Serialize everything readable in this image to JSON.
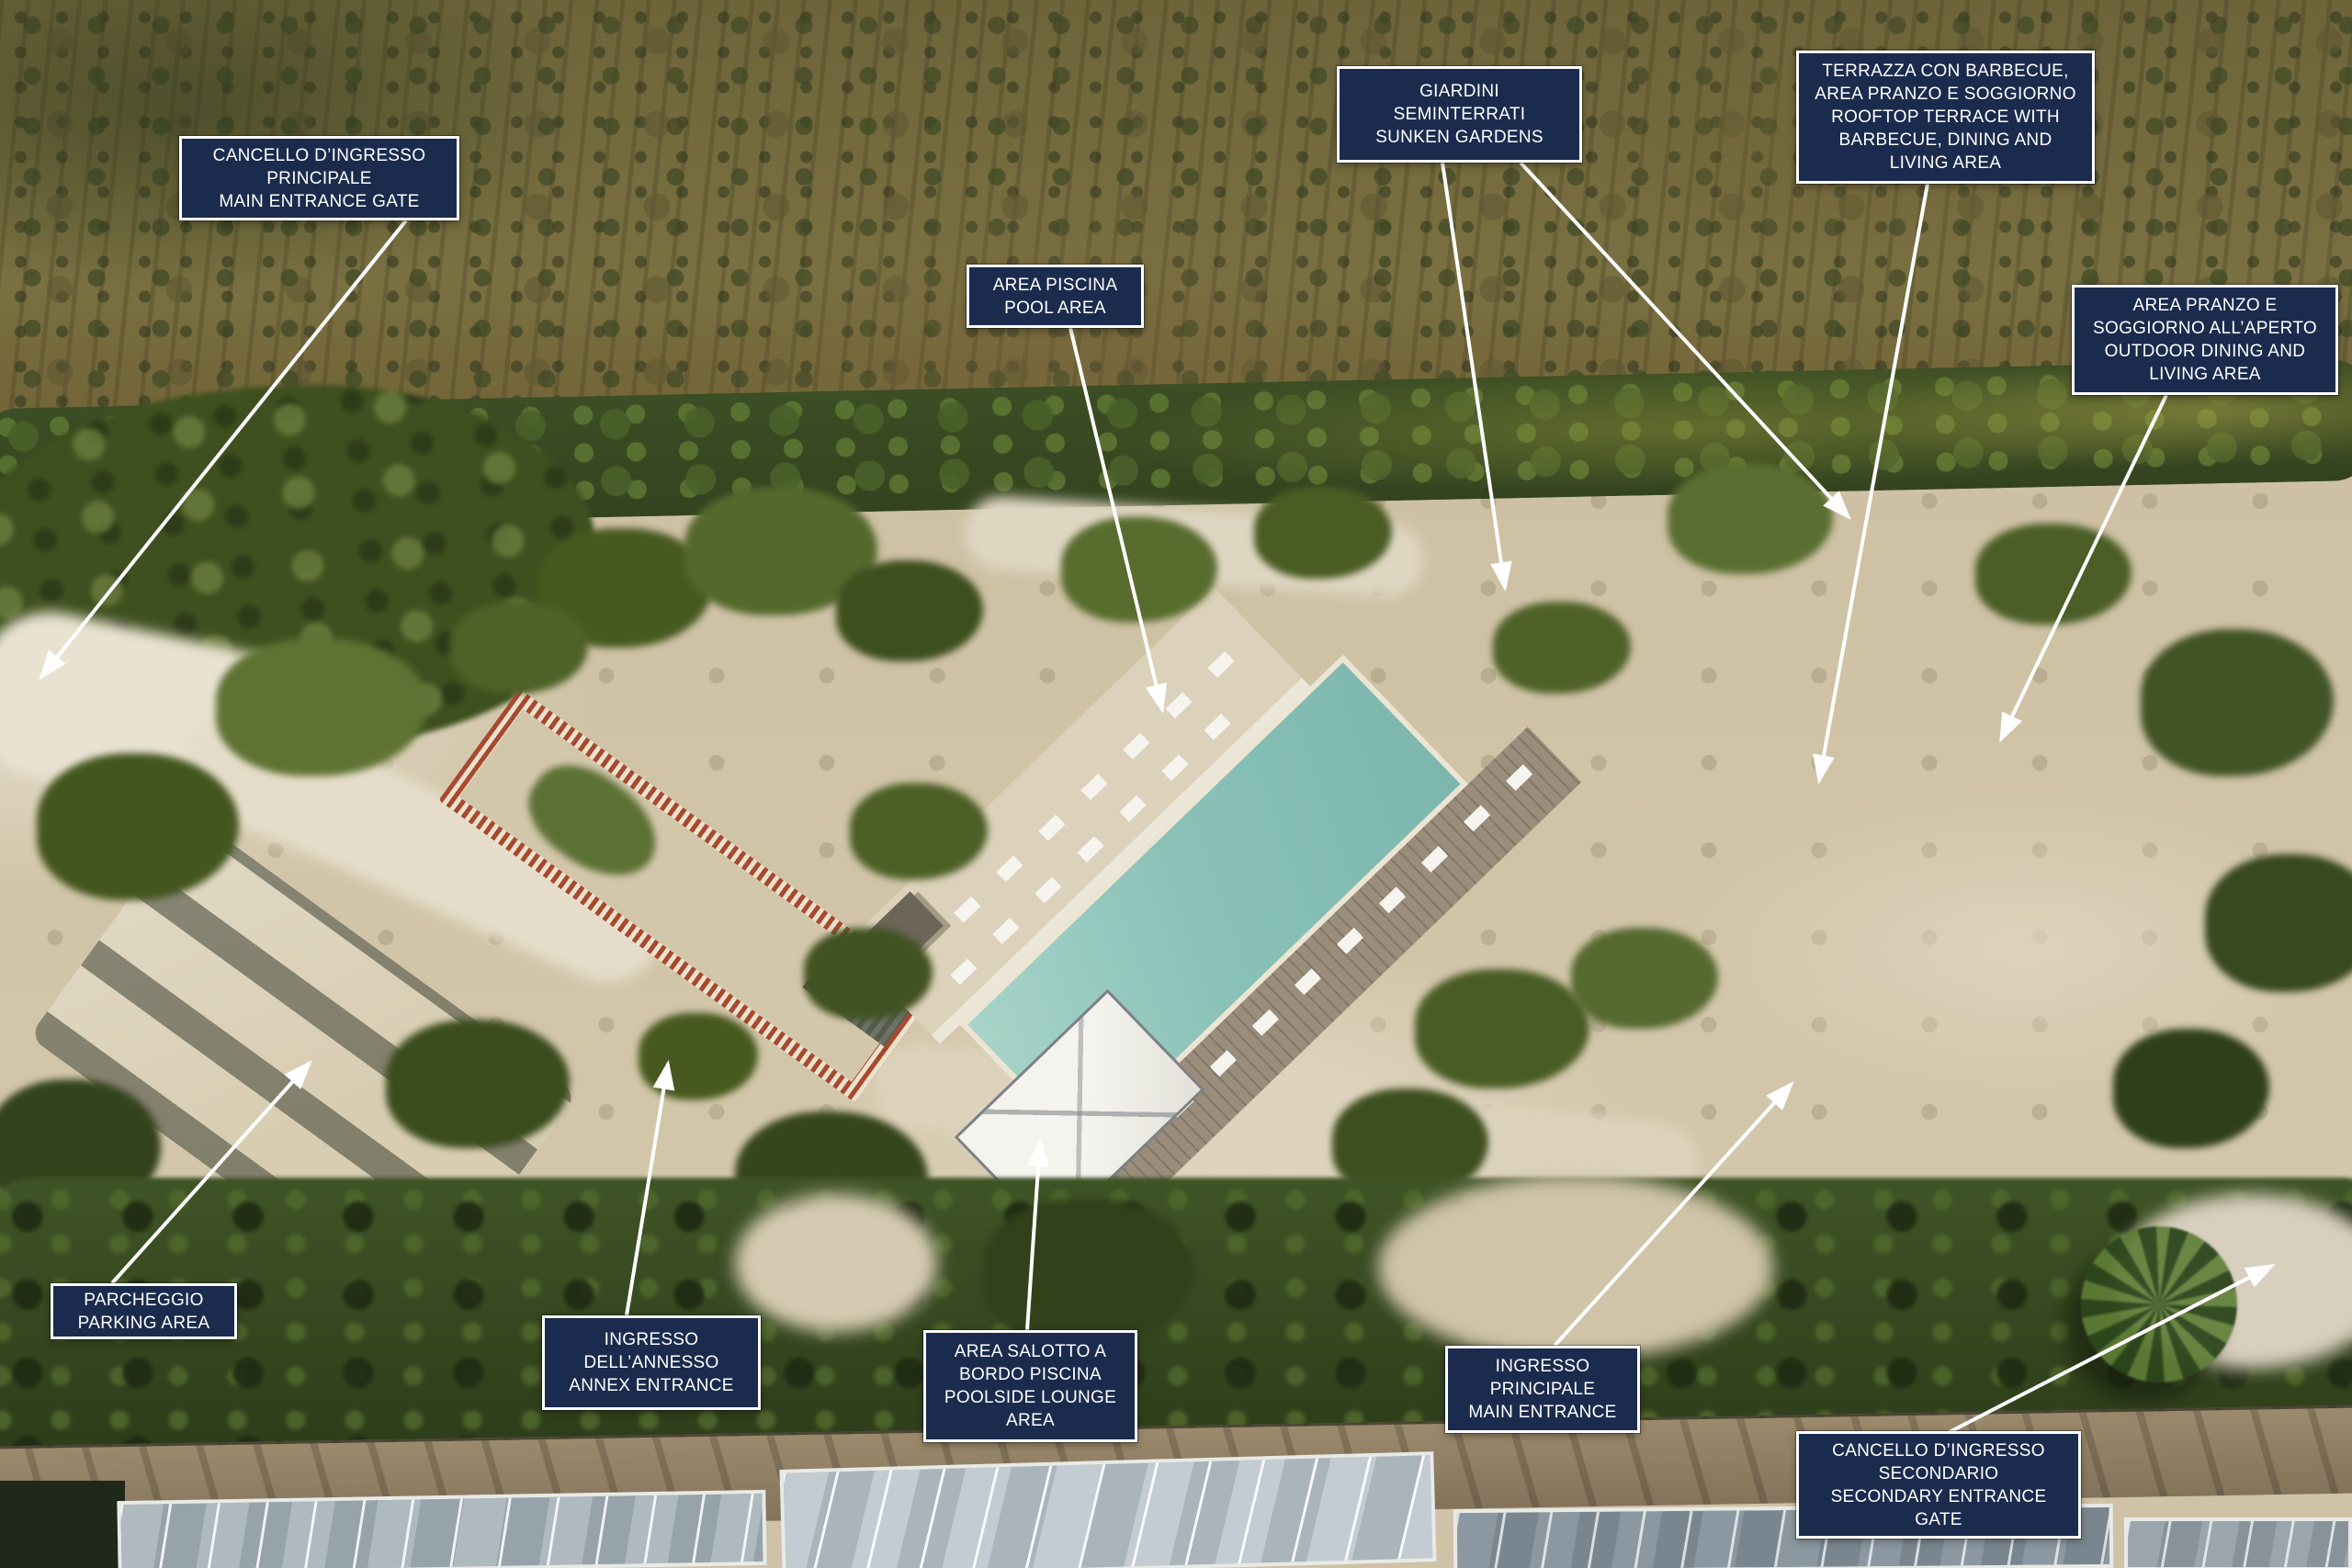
{
  "image": {
    "kind": "annotated aerial drone photograph of a villa estate"
  },
  "colors": {
    "label_background": "#1b2b4e",
    "label_border": "#ffffff",
    "label_text": "#ffffff",
    "leader_line": "#ffffff",
    "pool_water": "#8ac2b8"
  },
  "annotations": [
    {
      "id": "main-entrance-gate",
      "text": "CANCELLO D’INGRESSO\nPRINCIPALE\nMAIN ENTRANCE GATE"
    },
    {
      "id": "pool-area",
      "text": "AREA PISCINA\nPOOL AREA"
    },
    {
      "id": "sunken-gardens",
      "text": "GIARDINI\nSEMINTERRATI\nSUNKEN GARDENS"
    },
    {
      "id": "rooftop-terrace",
      "text": "TERRAZZA CON BARBECUE,\nAREA PRANZO E SOGGIORNO\nROOFTOP TERRACE WITH\nBARBECUE, DINING AND\nLIVING AREA"
    },
    {
      "id": "outdoor-dining",
      "text": "AREA PRANZO E\nSOGGIORNO ALL’APERTO\nOUTDOOR DINING AND\nLIVING AREA"
    },
    {
      "id": "parking-area",
      "text": "PARCHEGGIO\nPARKING AREA"
    },
    {
      "id": "annex-entrance",
      "text": "INGRESSO\nDELL’ANNESSO\nANNEX ENTRANCE"
    },
    {
      "id": "poolside-lounge",
      "text": "AREA SALOTTO A\nBORDO PISCINA\nPOOLSIDE LOUNGE\nAREA"
    },
    {
      "id": "main-entrance",
      "text": "INGRESSO\nPRINCIPALE\nMAIN ENTRANCE"
    },
    {
      "id": "secondary-entrance-gate",
      "text": "CANCELLO D’INGRESSO\nSECONDARIO\nSECONDARY ENTRANCE\nGATE"
    }
  ]
}
